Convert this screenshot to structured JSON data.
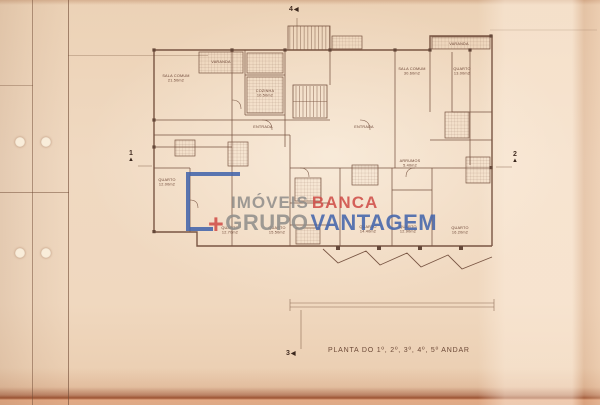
{
  "document": {
    "caption": "PLANTA DO 1º, 2º, 3º, 4º, 5º ANDAR"
  },
  "watermark": {
    "imoveis": "IMÓVEIS",
    "banca": "BANCA",
    "plus": "+",
    "grupo": "GRUPO",
    "vantagem": "VANTAGEM",
    "colors": {
      "grey": "#8f8d8a",
      "red": "#cf4a45",
      "blue": "#3f62ab"
    }
  },
  "plan": {
    "ink_color": "#6f4a38",
    "markers": [
      {
        "label": "1",
        "x": 128,
        "y": 150,
        "layout": "v",
        "tri": "▲"
      },
      {
        "label": "2",
        "x": 512,
        "y": 151,
        "layout": "v",
        "tri": "▲"
      },
      {
        "label": "3",
        "x": 286,
        "y": 350,
        "layout": "h",
        "tri": "◀"
      },
      {
        "label": "4",
        "x": 289,
        "y": 6,
        "layout": "h",
        "tri": "◀"
      }
    ],
    "rooms": [
      {
        "name": "SALA COMUM",
        "area": "21.50m2",
        "x": 176,
        "y": 77
      },
      {
        "name": "VARANDA",
        "area": "",
        "x": 221,
        "y": 63
      },
      {
        "name": "COZINHA",
        "area": "10.50m2",
        "x": 265,
        "y": 92
      },
      {
        "name": "SALA COMUM",
        "area": "30.60m2",
        "x": 412,
        "y": 70
      },
      {
        "name": "QUARTO",
        "area": "13.00m2",
        "x": 462,
        "y": 70
      },
      {
        "name": "VARANDA",
        "area": "",
        "x": 459,
        "y": 45
      },
      {
        "name": "ENTRADA",
        "area": "",
        "x": 263,
        "y": 128
      },
      {
        "name": "ENTRADA",
        "area": "",
        "x": 364,
        "y": 128
      },
      {
        "name": "QUARTO",
        "area": "12.00m2",
        "x": 167,
        "y": 181
      },
      {
        "name": "QUARTO",
        "area": "12.70m2",
        "x": 230,
        "y": 229
      },
      {
        "name": "QUARTO",
        "area": "15.50m2",
        "x": 277,
        "y": 229
      },
      {
        "name": "ARRUMOS",
        "area": "5.40m2",
        "x": 410,
        "y": 162
      },
      {
        "name": "QUARTO",
        "area": "14.40m2",
        "x": 368,
        "y": 228
      },
      {
        "name": "QUARTO",
        "area": "12.90m2",
        "x": 408,
        "y": 228
      },
      {
        "name": "QUARTO",
        "area": "16.20m2",
        "x": 460,
        "y": 229
      }
    ]
  }
}
